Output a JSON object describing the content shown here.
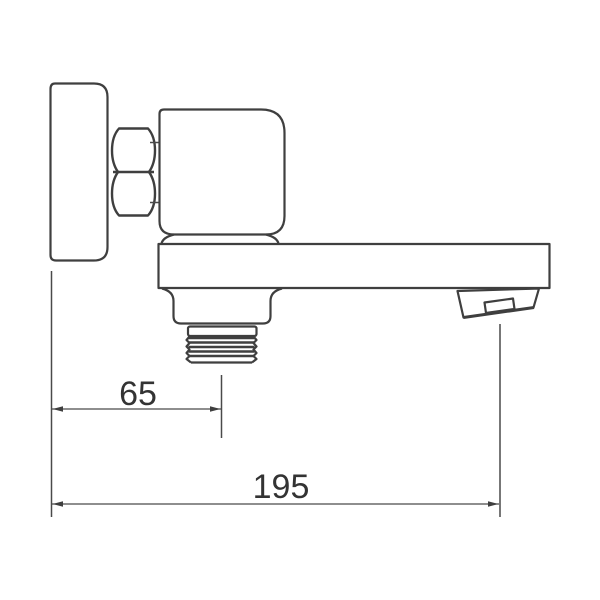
{
  "drawing": {
    "background": "#ffffff",
    "stroke_color": "#3f3f3f",
    "text_color": "#333333",
    "dimensions": {
      "wall_to_thread": {
        "label": "65"
      },
      "wall_to_nozzle": {
        "label": "195"
      }
    }
  }
}
